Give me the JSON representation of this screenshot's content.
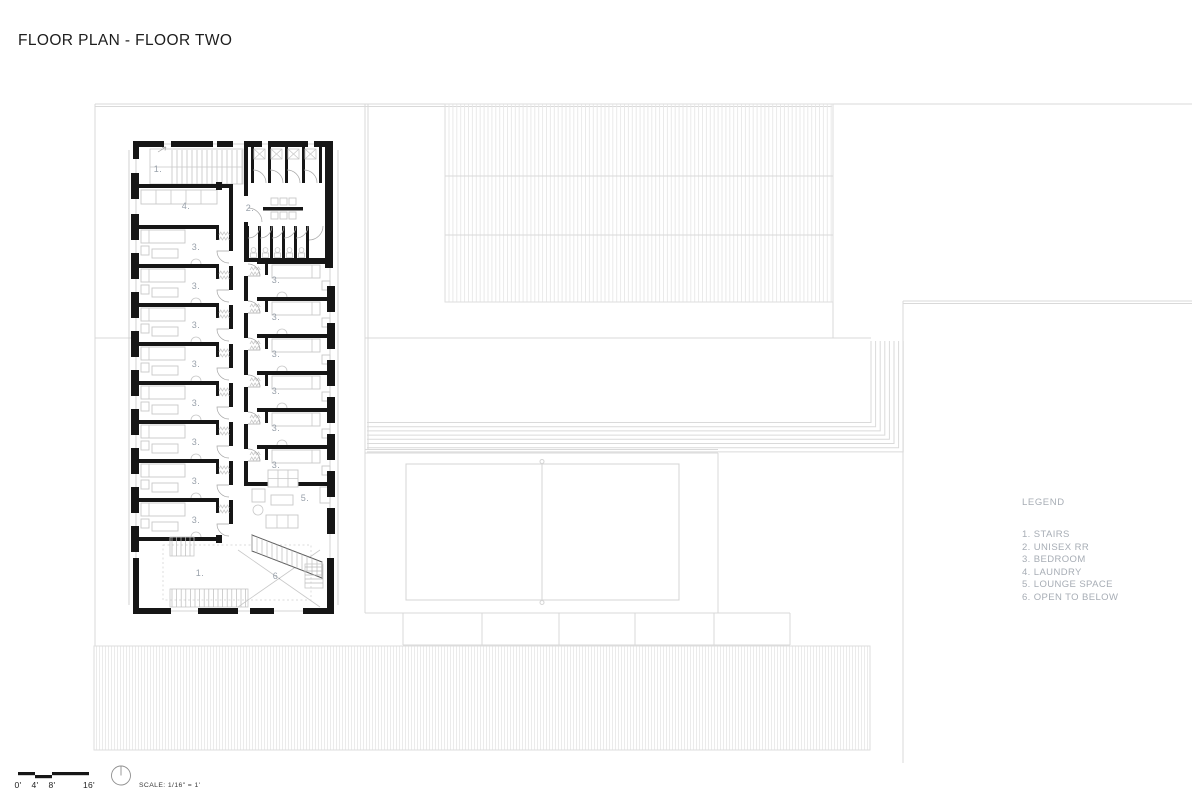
{
  "page": {
    "title": "FLOOR PLAN - FLOOR TWO"
  },
  "legend": {
    "title": "LEGEND",
    "items": [
      "1. STAIRS",
      "2. UNISEX RR",
      "3. BEDROOM",
      "4. LAUNDRY",
      "5. LOUNGE SPACE",
      "6. OPEN TO BELOW"
    ]
  },
  "scale_bar": {
    "labels": [
      "0'",
      "4'",
      "8'",
      "16'"
    ],
    "label_x": [
      18,
      35,
      52,
      89
    ],
    "note": "SCALE: 1/16\" = 1'"
  },
  "plan": {
    "colors": {
      "wall": "#161616",
      "site_line": "#d9d9d9",
      "furniture_line": "#c8c8c8",
      "label_text": "#99a1ab",
      "legend_text": "#a7adb5",
      "title_text": "#1d1d1d"
    },
    "room_labels": [
      {
        "t": "1.",
        "x": 158,
        "y": 172
      },
      {
        "t": "4.",
        "x": 186,
        "y": 209
      },
      {
        "t": "2.",
        "x": 250,
        "y": 211
      },
      {
        "t": "3.",
        "x": 196,
        "y": 250
      },
      {
        "t": "3.",
        "x": 196,
        "y": 289
      },
      {
        "t": "3.",
        "x": 196,
        "y": 328
      },
      {
        "t": "3.",
        "x": 196,
        "y": 367
      },
      {
        "t": "3.",
        "x": 196,
        "y": 406
      },
      {
        "t": "3.",
        "x": 196,
        "y": 445
      },
      {
        "t": "3.",
        "x": 196,
        "y": 484
      },
      {
        "t": "3.",
        "x": 196,
        "y": 523
      },
      {
        "t": "3.",
        "x": 276,
        "y": 283
      },
      {
        "t": "3.",
        "x": 276,
        "y": 320
      },
      {
        "t": "3.",
        "x": 276,
        "y": 357
      },
      {
        "t": "3.",
        "x": 276,
        "y": 394
      },
      {
        "t": "3.",
        "x": 276,
        "y": 431
      },
      {
        "t": "3.",
        "x": 276,
        "y": 468
      },
      {
        "t": "5.",
        "x": 305,
        "y": 501
      },
      {
        "t": "1.",
        "x": 200,
        "y": 576
      },
      {
        "t": "6.",
        "x": 277,
        "y": 579
      }
    ]
  }
}
